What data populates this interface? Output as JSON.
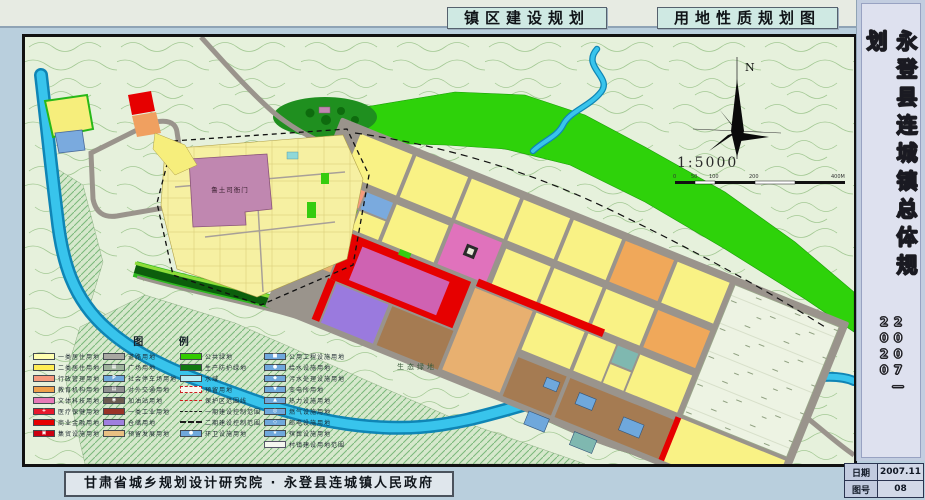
{
  "header": {
    "title_left": "镇区建设规划",
    "title_right": "用地性质规划图"
  },
  "sidebar": {
    "title": "永登县连城镇总体规划",
    "period": "2007—2020"
  },
  "footer": {
    "credits": "甘肃省城乡规划设计研究院 · 永登县连城镇人民政府",
    "date_label": "日期",
    "date_value": "2007.11",
    "sheet_label": "图号",
    "sheet_value": "08"
  },
  "map": {
    "labels": {
      "landmark": "鲁土司衙门",
      "eco_green": "生态绿地",
      "north": "N",
      "scale": "1:5000",
      "scalebar_ticks": [
        "0",
        "50",
        "100",
        "200",
        "400M"
      ]
    }
  },
  "legend": {
    "title": "图  例",
    "columns": [
      [
        {
          "label": "一类居住用地",
          "color": "#ffffb0",
          "type": "solid"
        },
        {
          "label": "二类居住用地",
          "color": "#ffee55",
          "type": "solid"
        },
        {
          "label": "行政管理用地",
          "color": "#f59a7d",
          "type": "solid"
        },
        {
          "label": "教育机构用地",
          "color": "#f0a04b",
          "type": "solid"
        },
        {
          "label": "文体科技用地",
          "color": "#e87ab8",
          "type": "solid"
        },
        {
          "label": "医疗保健用地",
          "color": "#e8192c",
          "type": "glyph",
          "glyph": "+"
        },
        {
          "label": "商业金融用地",
          "color": "#e60000",
          "type": "solid"
        },
        {
          "label": "集贸设施用地",
          "color": "#cc0011",
          "type": "glyph",
          "glyph": "▣"
        }
      ],
      [
        {
          "label": "道路用地",
          "color": "#a8a8a2",
          "type": "solid"
        },
        {
          "label": "广场用地",
          "color": "#9db39b",
          "type": "glyph",
          "glyph": "▦"
        },
        {
          "label": "社会停车场用地",
          "color": "#6fa8dc",
          "type": "glyph",
          "glyph": "P"
        },
        {
          "label": "对外交通用地",
          "color": "#8f8f8f",
          "type": "glyph",
          "glyph": "▤"
        },
        {
          "label": "加油站用地",
          "color": "#6b5b4f",
          "type": "glyph",
          "glyph": "◉"
        },
        {
          "label": "一类工业用地",
          "color": "#993327",
          "type": "solid"
        },
        {
          "label": "仓储用地",
          "color": "#9f7fdf",
          "type": "solid"
        },
        {
          "label": "预留发展用地",
          "color": "#e8c083",
          "type": "solid"
        }
      ],
      [
        {
          "label": "公共绿地",
          "color": "#33cc00",
          "type": "solid"
        },
        {
          "label": "生产防护绿地",
          "color": "#117a11",
          "type": "solid"
        },
        {
          "label": "水域",
          "color": "#b8ecf4",
          "type": "solid"
        },
        {
          "label": "预留用地",
          "color": "#f8f8ee",
          "type": "dashbox"
        },
        {
          "label": "保护区范围线",
          "color": "#dd2222",
          "type": "redline"
        },
        {
          "label": "一期建设控制范围",
          "color": "#222222",
          "type": "dashline"
        },
        {
          "label": "二期建设控制范围",
          "color": "#222222",
          "type": "dashline2"
        },
        {
          "label": "环卫设施用地",
          "color": "#6fa8dc",
          "type": "glyph",
          "glyph": "●"
        }
      ],
      [
        {
          "label": "公用工程设施用地",
          "color": "#6fa8dc",
          "type": "glyph",
          "glyph": "■"
        },
        {
          "label": "给水设施用地",
          "color": "#6fa8dc",
          "type": "glyph",
          "glyph": "●"
        },
        {
          "label": "污水处理设施用地",
          "color": "#6fa8dc",
          "type": "glyph",
          "glyph": "◆"
        },
        {
          "label": "变电所用地",
          "color": "#6fa8dc",
          "type": "glyph",
          "glyph": "▼"
        },
        {
          "label": "热力设施用地",
          "color": "#6fa8dc",
          "type": "glyph",
          "glyph": "▲"
        },
        {
          "label": "燃气设施用地",
          "color": "#6fa8dc",
          "type": "glyph",
          "glyph": "◎"
        },
        {
          "label": "邮电设施用地",
          "color": "#6fa8dc",
          "type": "glyph",
          "glyph": "◇"
        },
        {
          "label": "殡葬设施用地",
          "color": "#6fa8dc",
          "type": "glyph",
          "glyph": "★"
        },
        {
          "label": "村镇建设用地范围",
          "color": "#f4f6ee",
          "type": "dashbox2"
        }
      ]
    ]
  },
  "colors": {
    "page_bg": "#b9cfdd",
    "water": "#38c4ec",
    "public_green": "#33cc00",
    "residential": "#fdf6a0",
    "commercial": "#e60000",
    "road": "#9a948c"
  }
}
